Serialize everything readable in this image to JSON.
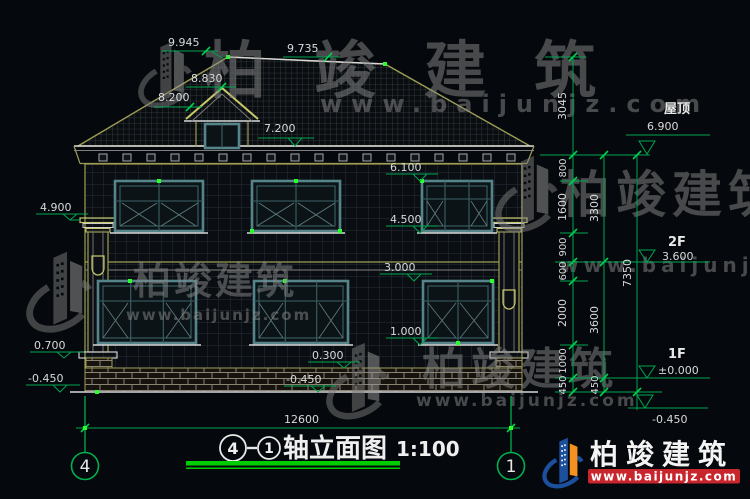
{
  "drawing": {
    "title": {
      "axis_left": "4",
      "axis_right": "1",
      "name": "轴立面图",
      "scale": "1:100"
    },
    "width_dim": "12600",
    "top_dims": {
      "ridge": "9.945",
      "ridge_right": "9.735",
      "dormer_ridge": "8.830",
      "dormer_eave": "8.200"
    },
    "center_levels": {
      "eave": "7.200",
      "f2_head": "6.100",
      "f2_sill": "4.500",
      "f1_head": "3.000",
      "f1_sill": "1.000",
      "plinth": "0.300",
      "ground": "-0.450"
    },
    "left_levels": {
      "capital": "4.900",
      "base": "0.700",
      "ground": "-0.450"
    },
    "right_chain_a": [
      "3045",
      "800",
      "1600",
      "900",
      "600",
      "2000",
      "1000",
      "450"
    ],
    "right_chain_b": [
      "3300",
      "3600",
      "450"
    ],
    "right_chain_total": "7350",
    "right_levels": {
      "roof_name": "屋顶",
      "roof": "6.900",
      "f2_name": "2F",
      "f2": "3.600",
      "f1_name": "1F",
      "f1": "±0.000",
      "ground": "-0.450"
    }
  },
  "watermark": {
    "name": "柏竣建筑",
    "url": "www.baijunjz.com"
  },
  "brand": {
    "name": "柏竣建筑",
    "url": "www.baijunjz.com"
  },
  "colors": {
    "background": "#05080c",
    "dim_green": "#00a651",
    "outline_yellow": "#9d9d55",
    "window_teal": "#55848a",
    "text_white": "#d9d9d9",
    "title_underline": "#00cc00",
    "brand_blue": "#1c4f9c",
    "brand_orange": "#f59120",
    "brand_red": "#c9252c"
  }
}
